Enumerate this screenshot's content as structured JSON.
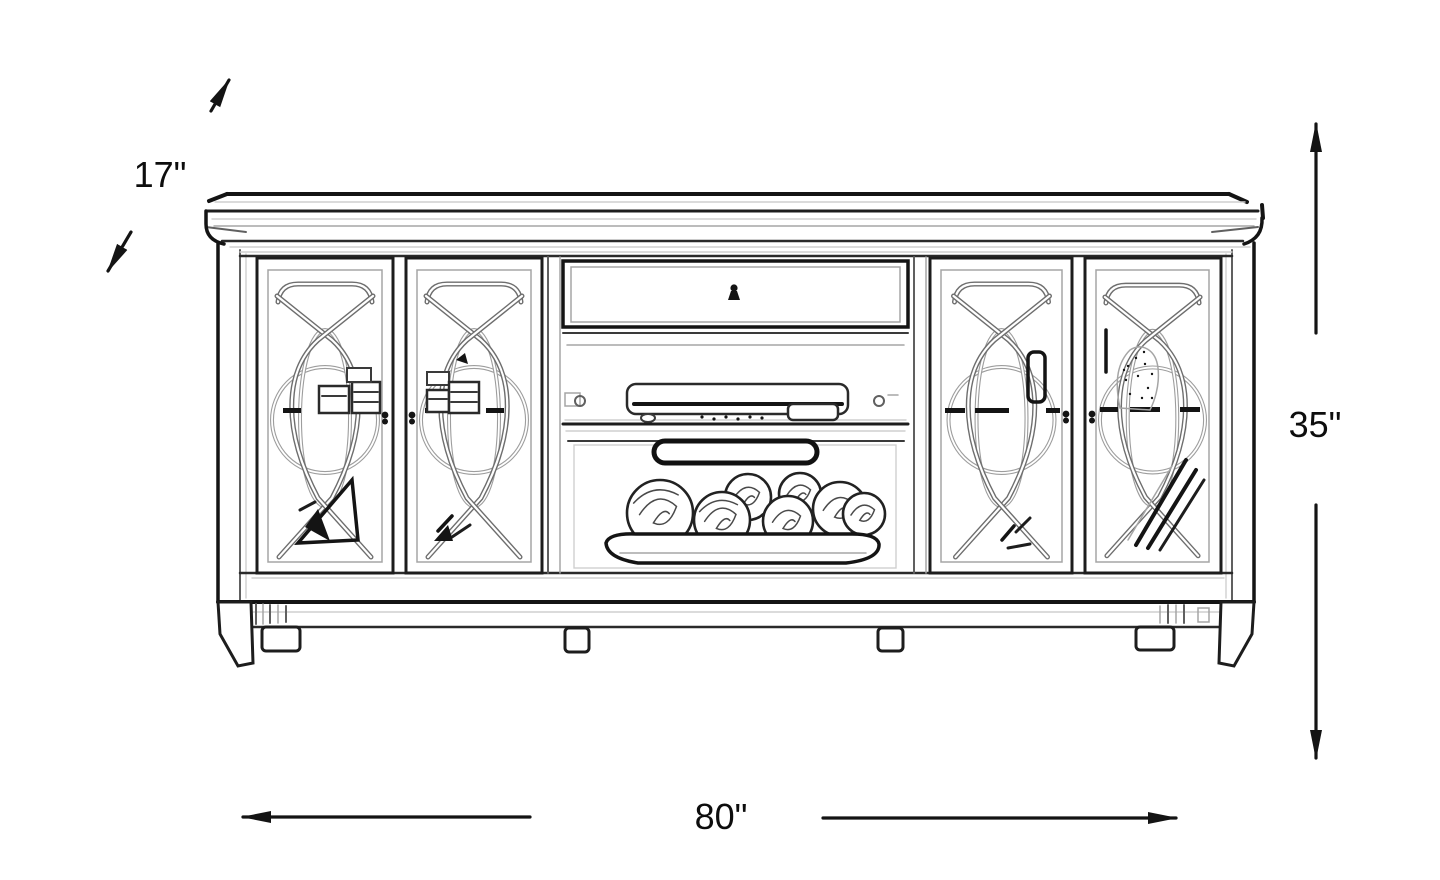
{
  "diagram": {
    "subject": "TV console / media cabinet dimension line drawing",
    "depth_label": "17\"",
    "height_label": "35\"",
    "width_label": "80\""
  },
  "colors": {
    "ink": "#141414",
    "sketch_light": "#a5a5a5",
    "background": "#ffffff"
  }
}
